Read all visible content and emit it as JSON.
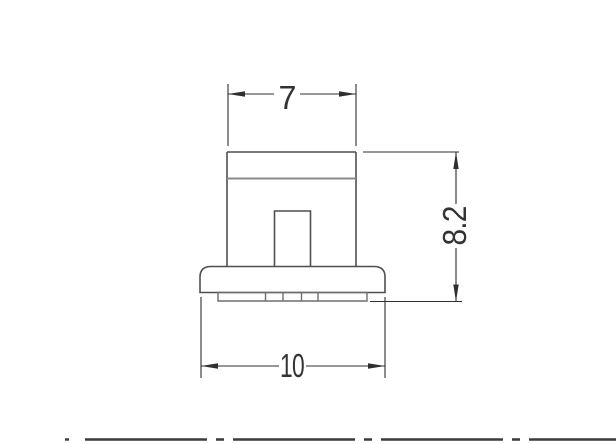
{
  "drawing": {
    "view": "component-front-view",
    "dimensions": {
      "top_width": {
        "value": "7"
      },
      "overall_height": {
        "value": "8.2"
      },
      "base_width": {
        "value": "10"
      }
    },
    "colors": {
      "background": "#ffffff",
      "outline": "#4f4f4f",
      "inner_line": "#8a8a8a",
      "detail_lines": "#6e6e6e",
      "dimension_lines": "#2f2f2f",
      "dimension_text": "#333333",
      "centerline": "#3a3a3a"
    }
  }
}
